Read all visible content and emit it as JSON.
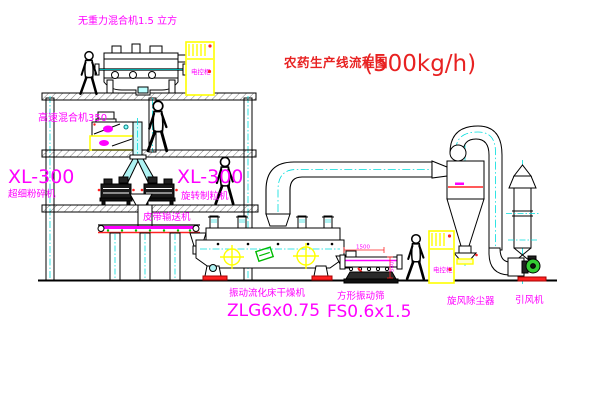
{
  "title": {
    "text": "农药生产线流程图",
    "capacity": "(500kg/h)"
  },
  "labels": {
    "gravity_mixer": "无重力混合机1.5 立方",
    "high_speed_mixer": "高速混合机350",
    "pulverizer_model": "XL-300",
    "pulverizer_name": "超细粉碎机",
    "granulator_model": "XL-300",
    "granulator_name": "旋转制粒机",
    "belt_conveyor": "皮带输送机",
    "dryer_name": "振动流化床干燥机",
    "dryer_model": "ZLG6x0.75",
    "screen_name": "方形振动筛",
    "screen_model": "FS0.6x1.5",
    "cyclone": "旋风除尘器",
    "fan": "引风机",
    "cabinet_top": "电控柜",
    "cabinet_right": "电控柜"
  },
  "dimensions": {
    "screen_length": "1500",
    "screen_height": "540"
  },
  "colors": {
    "background": "#ffffff",
    "line": "#000000",
    "label_magenta": "#ff00ff",
    "title_red": "#e82222",
    "cabinet_yellow": "#ffff00",
    "centerline_cyan": "#00dddd",
    "accent_green": "#00bb00",
    "accent_red": "#ff2222"
  }
}
